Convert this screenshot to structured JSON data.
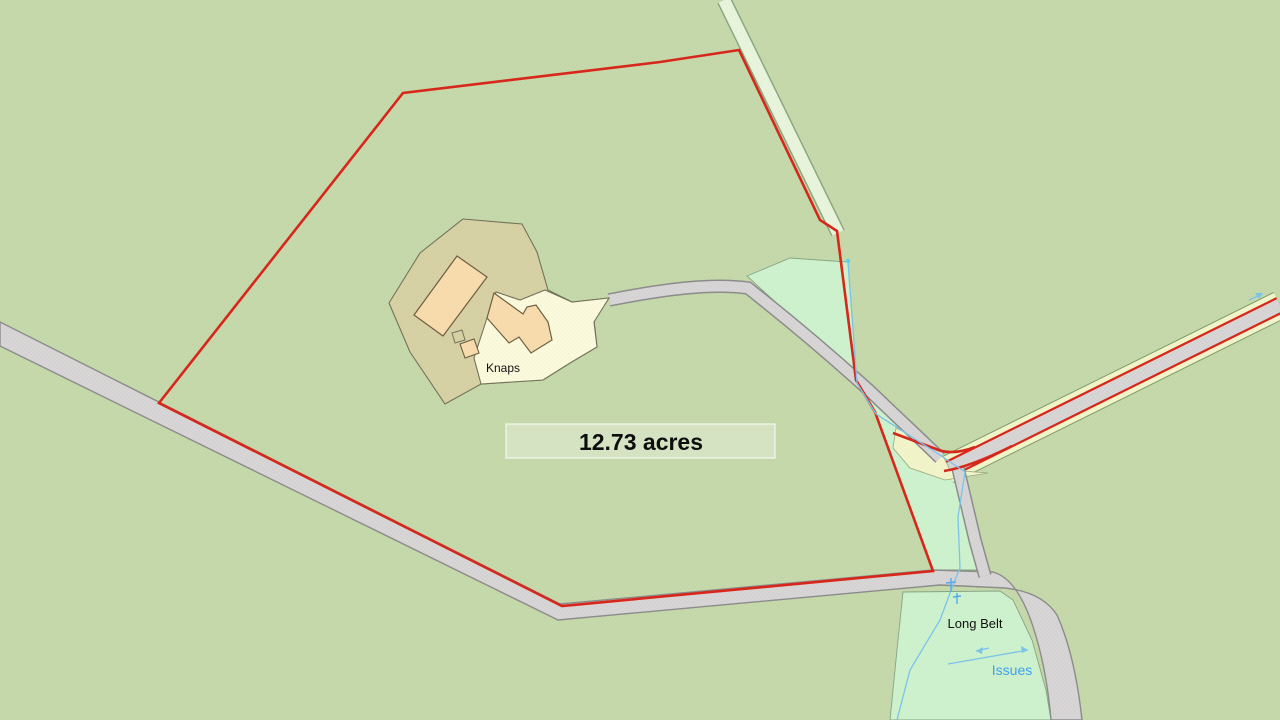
{
  "map": {
    "area_label": "12.73 acres",
    "labels": {
      "property": "Knaps",
      "woodland": "Long Belt",
      "annotation": "Issues"
    }
  },
  "colors": {
    "background": "#c6d9ab",
    "parcel_boundary": "#d8261a",
    "woodland": "#cdf2cd",
    "road_fill": "#d7d5d5",
    "road_casing": "#8c8c8c",
    "curtilage": "#d7d1a5",
    "yard": "#fbfadd",
    "building": "#f8dcae",
    "building_outline": "#6e5f41",
    "verge": "#f2f5c9",
    "verge_edge": "#7d9b6b",
    "water": "#7cc4ec",
    "water_label": "#3da1f2",
    "text": "#111111"
  }
}
